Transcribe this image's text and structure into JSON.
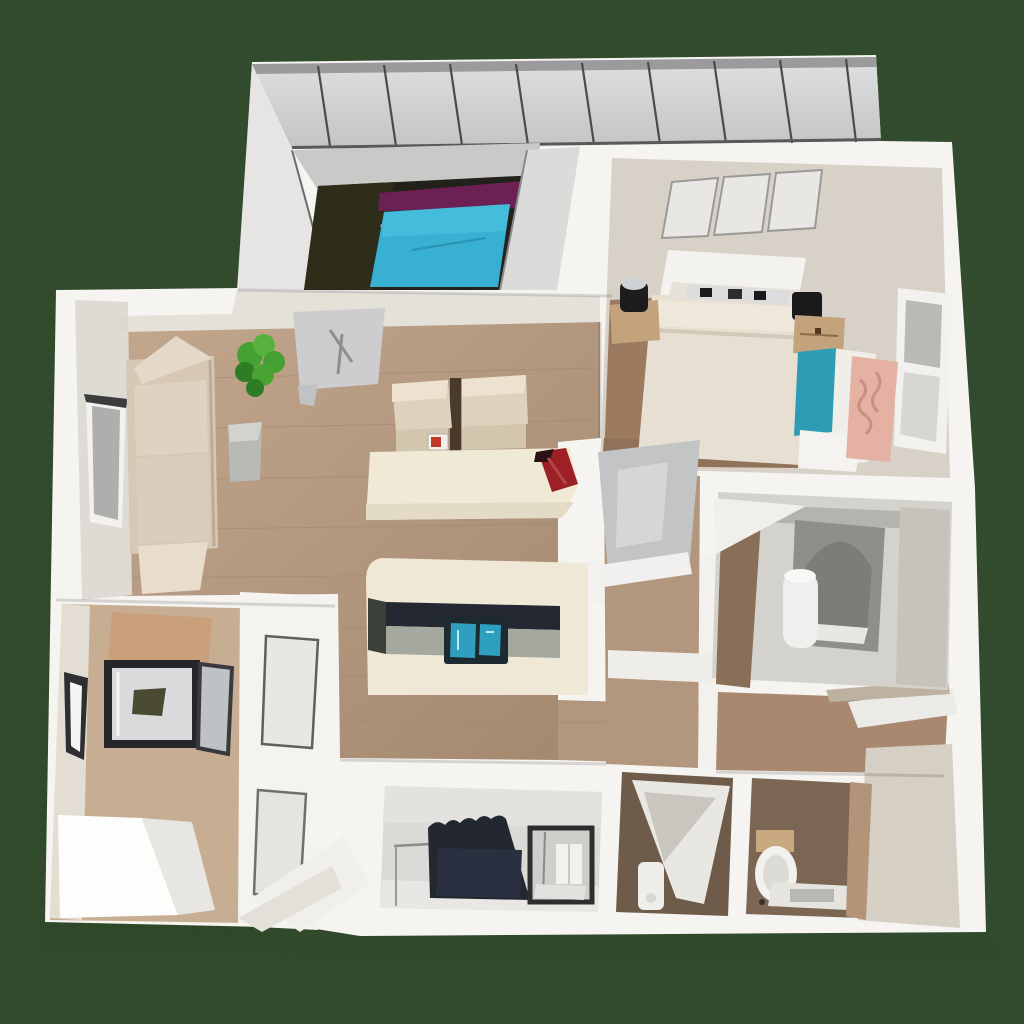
{
  "scene": {
    "description": "Top-down 3D dollhouse render of an apartment floor plan on a dark green lawn",
    "view": "overhead isometric",
    "visible_text": "none"
  },
  "palette": {
    "lawn_green": "#41603a",
    "lawn_shadow": "#2c4527",
    "wall_white": "#f5f4f1",
    "wall_shade": "#e2e1de",
    "roof_gray": "#d3d4d6",
    "roof_seam": "#4b4b4d",
    "media_floor_dark": "#22221a",
    "media_floor_olive": "#2e2d1a",
    "pool_teal": "#38b0d2",
    "pool_purple": "#6b2153",
    "bedroom_wall_beige": "#d8d1c7",
    "bed_cream": "#e7dfd1",
    "headboard_white": "#f4f2ee",
    "nightstand_tan": "#c2a37c",
    "armchair_teal": "#2f9cb5",
    "blanket_pink": "#e5b1a3",
    "floor_tan": "#b2977e",
    "floor_plank": "#a0866d",
    "sofa_beige": "#d7c8b6",
    "plant_green": "#44a132",
    "mat_gray": "#cdcdcf",
    "counter_cream": "#efe8d6",
    "counter_dark": "#232832",
    "sink_teal": "#2f9fc0",
    "accent_red": "#9c2026",
    "bath_floor_gray": "#d4d2cc",
    "tub_gray": "#8f8e8a",
    "hall_door_gray": "#c2c4c5",
    "storage_wall_tan": "#c7ae92",
    "cabinet_tan": "#c9a07b",
    "glass_gray": "#d9dadc",
    "laundry_floor": "#dcdad6",
    "appliance_dark": "#232730",
    "wc_brown": "#6f5b4a",
    "wc_brown_light": "#7b6654",
    "corner_beige": "#d6cfc4"
  },
  "rooms": [
    {
      "name": "media-room",
      "items": [
        "teal-pool-table",
        "purple-runner",
        "dark-floor",
        "slatted-roof"
      ]
    },
    {
      "name": "bedroom",
      "items": [
        "double-bed",
        "headboard-shelf",
        "left-nightstand",
        "right-nightstand",
        "three-skylights",
        "side-window",
        "teal-armchair",
        "pink-blanket"
      ]
    },
    {
      "name": "living-room",
      "items": [
        "l-shaped-sofa",
        "potted-plant",
        "wall-mat",
        "gray-side-table",
        "left-window"
      ]
    },
    {
      "name": "dining-area",
      "items": [
        "cream-table",
        "two-beige-chairs",
        "red-centerpiece",
        "chair-label"
      ]
    },
    {
      "name": "kitchen",
      "items": [
        "island-counter",
        "dark-cooktop-strip",
        "teal-double-sink"
      ]
    },
    {
      "name": "bathroom",
      "items": [
        "bathtub",
        "white-cylinder",
        "corner-shelf"
      ]
    },
    {
      "name": "hallway",
      "items": [
        "leaning-gray-door",
        "open-white-door",
        "wall-shelf"
      ]
    },
    {
      "name": "storage-room",
      "items": [
        "glass-display-cabinet",
        "white-chest",
        "window-slot",
        "paneled-partition",
        "white-ramp"
      ]
    },
    {
      "name": "laundry-room",
      "items": [
        "dark-appliance",
        "glass-shower-cabinet",
        "wall-rail"
      ]
    },
    {
      "name": "wc",
      "items": [
        "toilet",
        "tan-cistern",
        "tissue-tray",
        "open-closet-door",
        "white-cylinder"
      ]
    }
  ]
}
